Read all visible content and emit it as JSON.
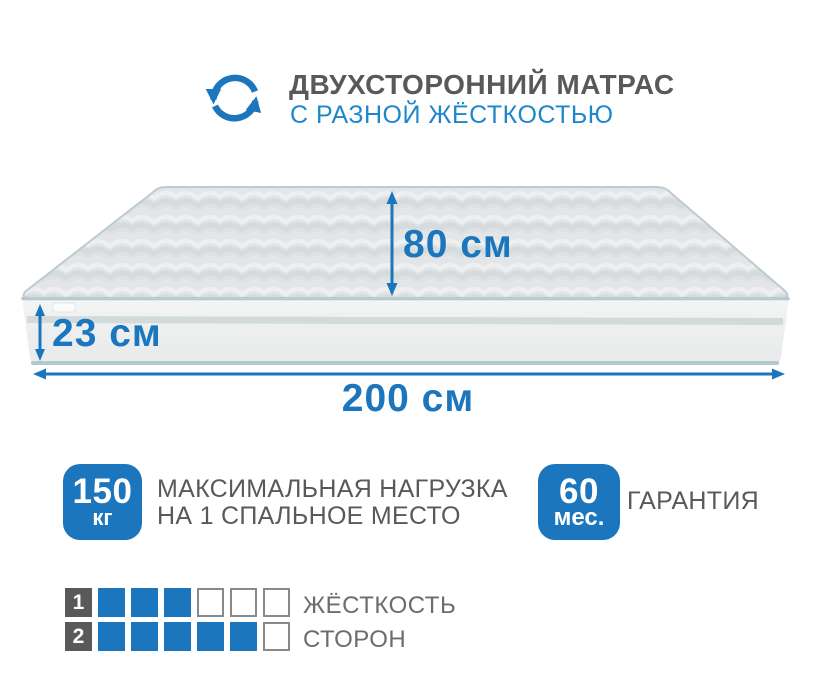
{
  "header": {
    "icon": "rotate-arrows-icon",
    "title": "ДВУХСТОРОННИЙ МАТРАС",
    "subtitle": "С РАЗНОЙ ЖЁСТКОСТЬЮ"
  },
  "mattress": {
    "height_label": "80 см",
    "thickness_label": "23 см",
    "width_label": "200 см"
  },
  "badges": [
    {
      "value": "150",
      "unit": "кг",
      "label_line1": "МАКСИМАЛЬНАЯ НАГРУЗКА",
      "label_line2": "НА 1 СПАЛЬНОЕ МЕСТО"
    },
    {
      "value": "60",
      "unit": "мес.",
      "label_line1": "ГАРАНТИЯ"
    }
  ],
  "firmness_scale": {
    "rows": [
      {
        "number": "1",
        "filled": 3,
        "total": 6
      },
      {
        "number": "2",
        "filled": 5,
        "total": 6
      }
    ],
    "label_line1": "ЖЁСТКОСТЬ",
    "label_line2": "СТОРОН"
  },
  "colors": {
    "accent_blue": "#1b76bd",
    "subtitle_blue": "#1e87cc",
    "title_gray": "#58595b",
    "label_gray": "#6b6c6e"
  }
}
